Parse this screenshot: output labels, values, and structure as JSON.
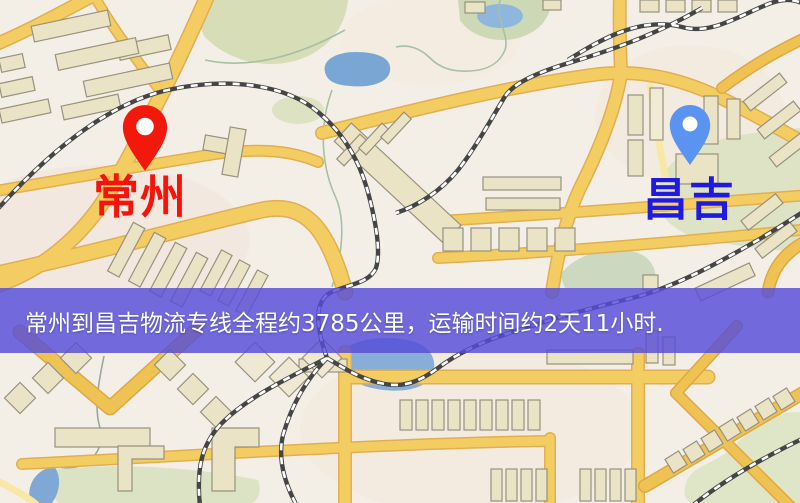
{
  "map": {
    "origin": {
      "label": "常州",
      "label_color": "#f5130a",
      "pin_icon": "red-location-pin",
      "pin_color": "#f2180c"
    },
    "destination": {
      "label": "昌吉",
      "label_color": "#201ae0",
      "pin_icon": "blue-location-pin",
      "pin_color": "#5b93f0"
    }
  },
  "banner": {
    "text": "常州到昌吉物流专线全程约3785公里，运输时间约2天11小时.",
    "background_color": "#554dd9",
    "text_color": "#ffffff"
  },
  "palette": {
    "map_background": "#f4efe6",
    "road_fill": "#f3cd62",
    "road_casing": "#e2ae52",
    "orange_road_fill": "#efc254",
    "minor_road_fill": "#f8e7a6",
    "building_fill": "#ebe3c6",
    "building_stroke": "#97917e",
    "park_green": "#d7ddb6",
    "water_blue": "#7aa6d4",
    "railway_color": "#454545"
  }
}
